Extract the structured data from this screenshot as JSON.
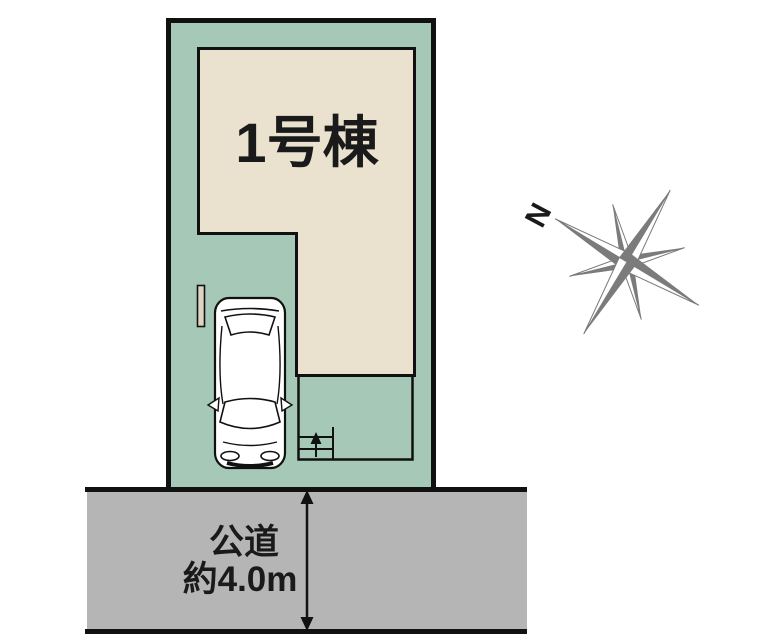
{
  "plan": {
    "building_label": "1号棟",
    "road_label_line1": "公道",
    "road_label_line2": "約4.0m",
    "compass_north_label": "N"
  },
  "colors": {
    "lot_fill": "#a6c8b7",
    "building_fill": "#eae2cf",
    "road_fill": "#b5b5b5",
    "gate_fill": "#ddd5c4",
    "line": "#111111",
    "compass": "#7b7b7b",
    "text": "#1a1a1a"
  }
}
